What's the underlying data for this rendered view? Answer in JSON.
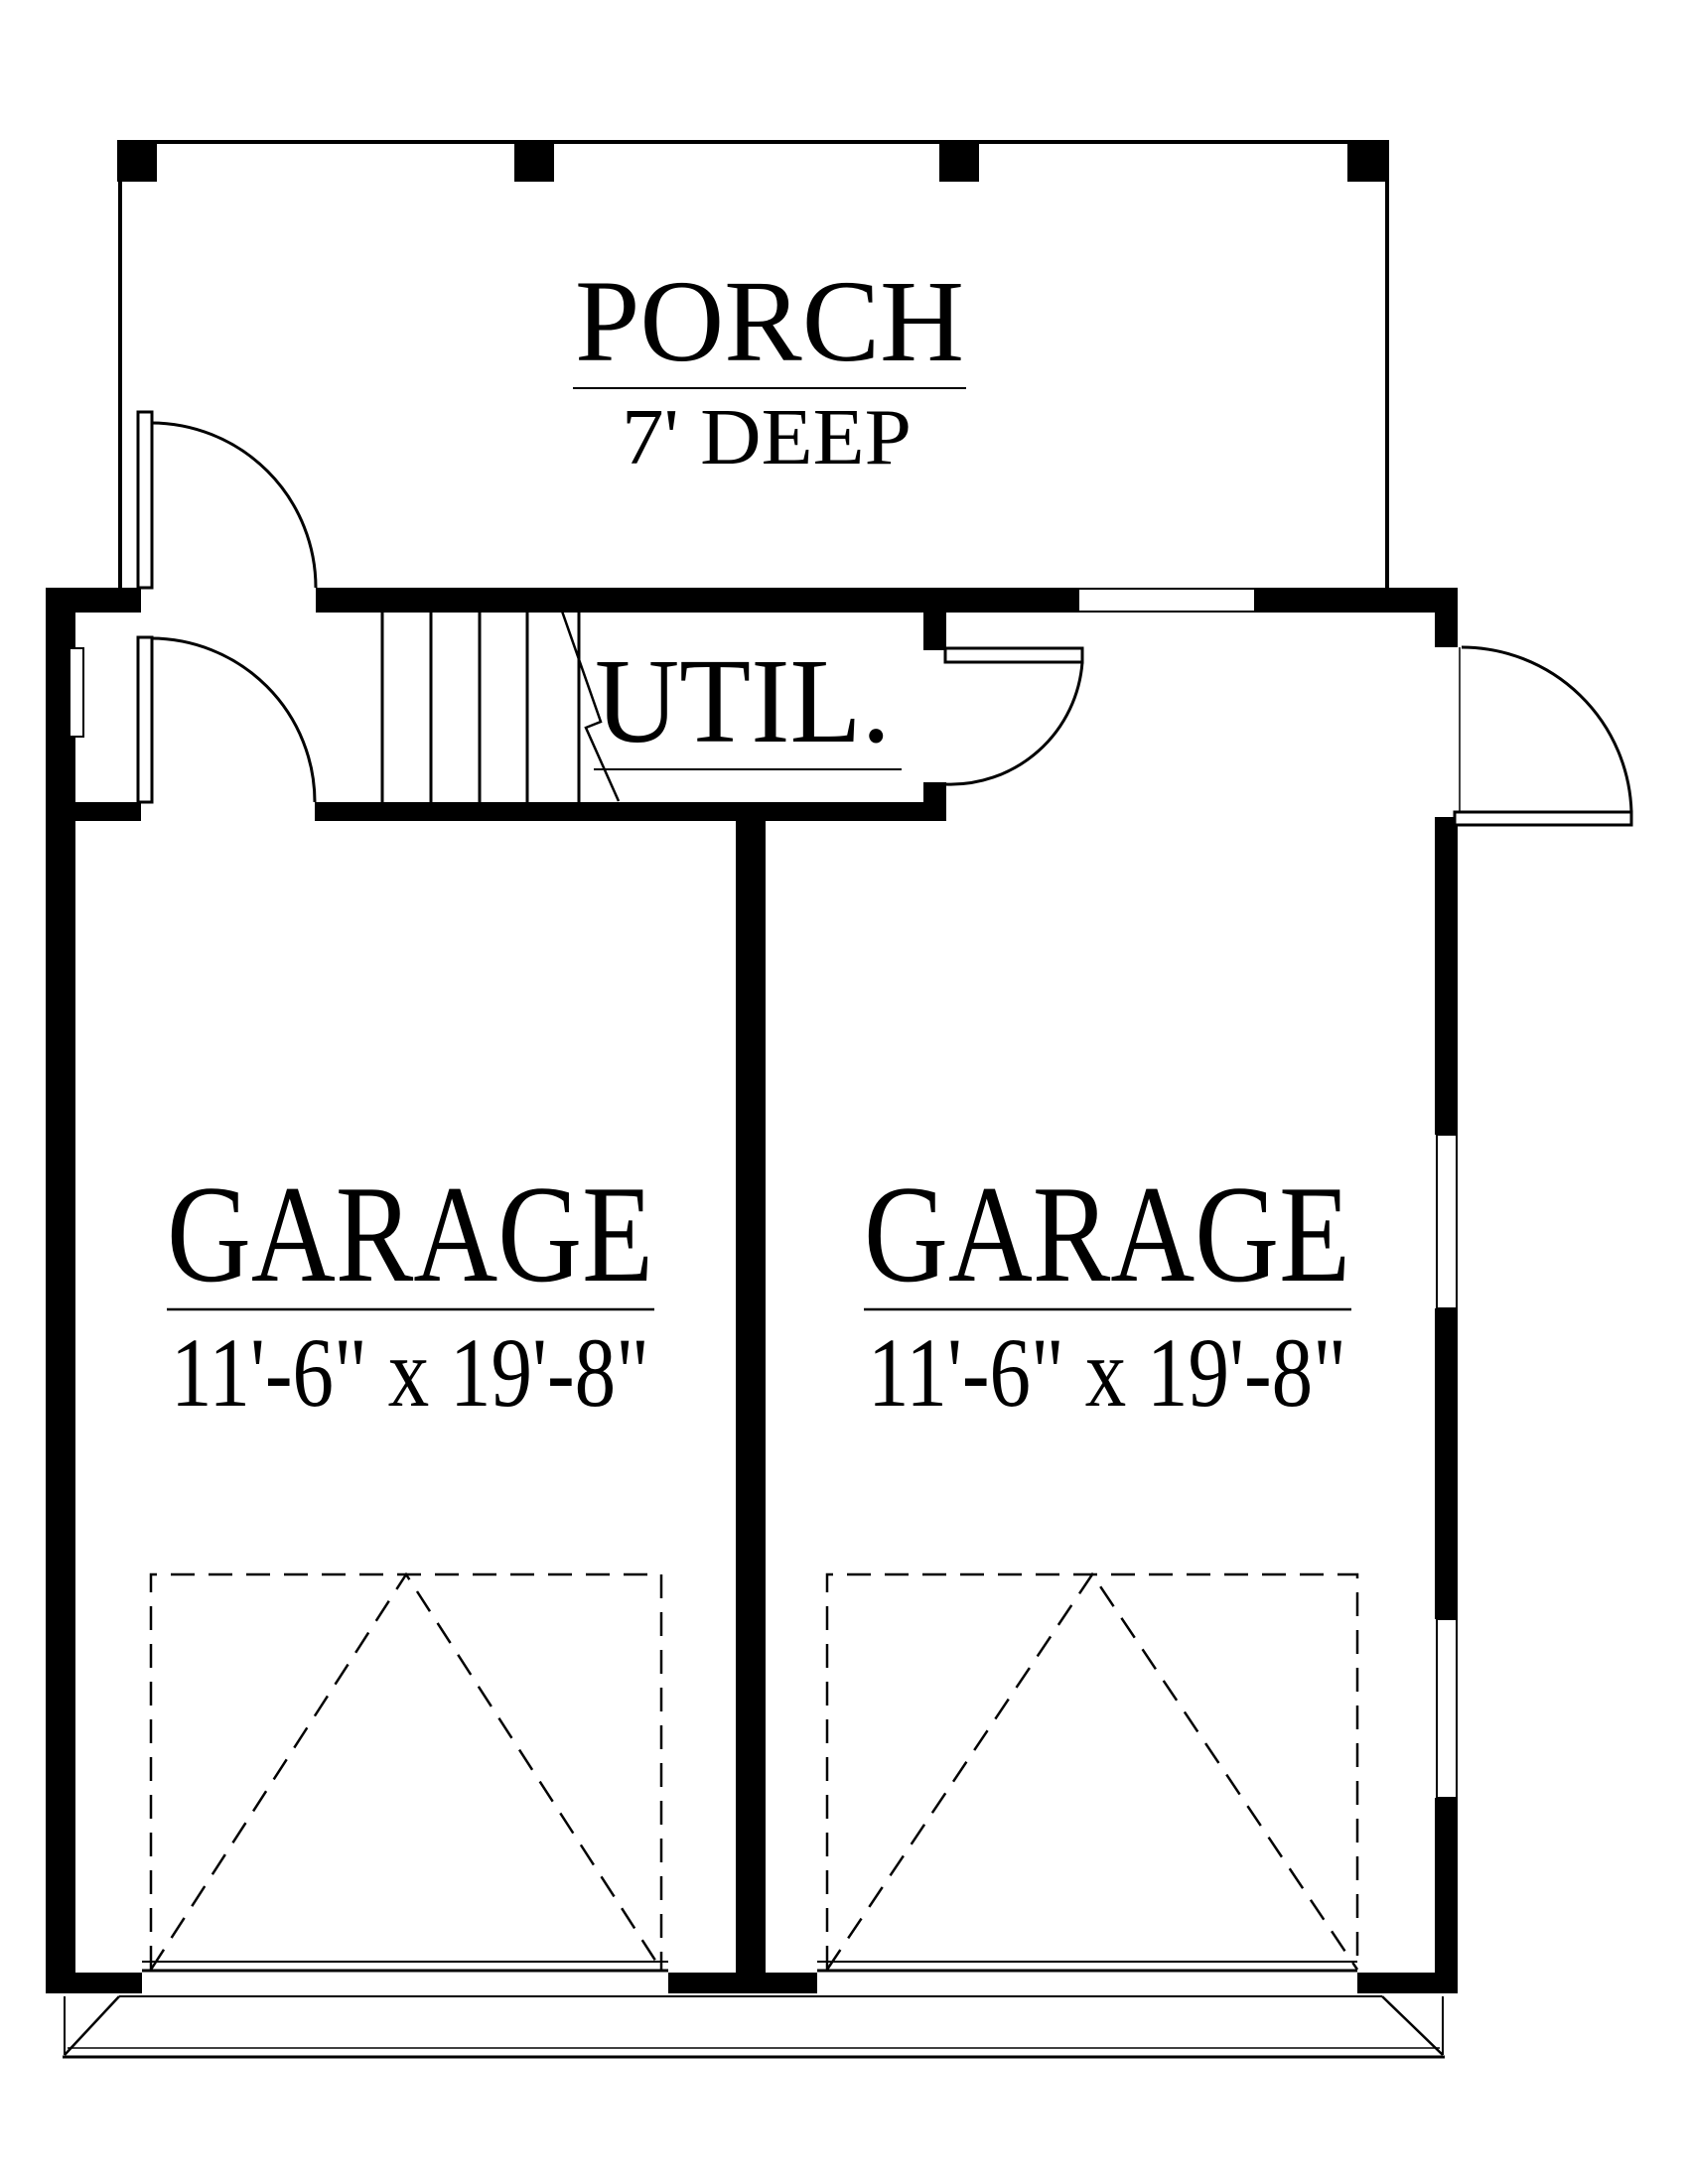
{
  "plan": {
    "rooms": {
      "porch": {
        "name": "PORCH",
        "depth": "7' DEEP"
      },
      "utility": {
        "name": "UTIL."
      },
      "garage_left": {
        "name": "GARAGE",
        "size": "11'-6\" x 19'-8\""
      },
      "garage_right": {
        "name": "GARAGE",
        "size": "11'-6\" x 19'-8\""
      }
    },
    "colors": {
      "ink": "#000000",
      "paper": "#ffffff"
    }
  }
}
